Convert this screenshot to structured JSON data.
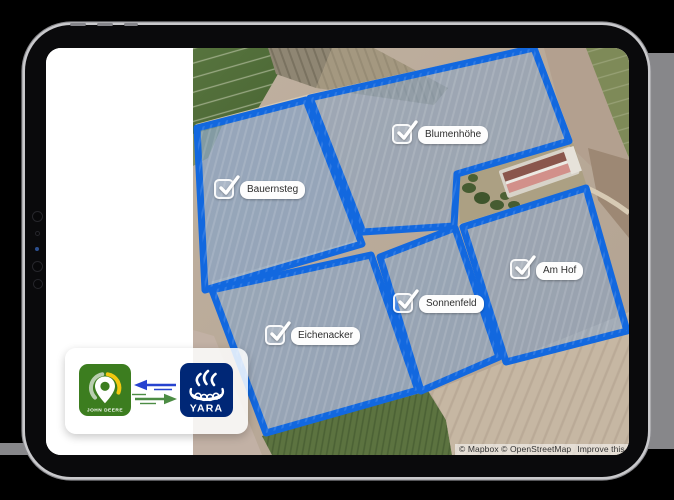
{
  "colors": {
    "page_background": "#000000",
    "backdrop_gray": "#87878A",
    "field_border": "#1268DF",
    "field_fill": "#7FA2CC",
    "jd_green": "#3C7D1F",
    "jd_yellow": "#F3C80F",
    "yara_navy": "#002776",
    "sync_blue": "#2743CF",
    "sync_green": "#4C8C44"
  },
  "device": {
    "type": "tablet",
    "orientation": "landscape"
  },
  "screen": {
    "left_panel": {
      "content": ""
    },
    "map": {
      "attribution": {
        "copyright": "© Mapbox © OpenStreetMap",
        "improve_link": "Improve this map"
      },
      "fields": [
        {
          "id": "bauernsteg",
          "name": "Bauernsteg",
          "checked": true,
          "polygon": "197,128 306,100 362,244 205,290",
          "fill_opacity": 0.62,
          "checkbox_pos": [
            214,
            179
          ],
          "label_pos": [
            240,
            180
          ]
        },
        {
          "id": "blumenhoehe",
          "name": "Blumenhöhe",
          "checked": true,
          "polygon": "310,98 534,48 569,141 457,174 454,226 363,232",
          "fill_opacity": 0.5,
          "checkbox_pos": [
            392,
            124
          ],
          "label_pos": [
            418,
            125
          ]
        },
        {
          "id": "eichenacker",
          "name": "Eichenacker",
          "checked": true,
          "polygon": "212,290 371,255 418,390 266,433",
          "fill_opacity": 0.58,
          "checkbox_pos": [
            265,
            325
          ],
          "label_pos": [
            291,
            326
          ]
        },
        {
          "id": "sonnenfeld",
          "name": "Sonnenfeld",
          "checked": true,
          "polygon": "380,257 455,228 499,357 421,391",
          "fill_opacity": 0.55,
          "checkbox_pos": [
            393,
            293
          ],
          "label_pos": [
            419,
            294
          ]
        },
        {
          "id": "amhof",
          "name": "Am Hof",
          "checked": true,
          "polygon": "463,227 586,188 627,331 506,362",
          "fill_opacity": 0.5,
          "checkbox_pos": [
            510,
            259
          ],
          "label_pos": [
            536,
            261
          ]
        }
      ]
    },
    "sync_overlay": {
      "john_deere_label": "JOHN DEERE",
      "yara_label": "YARA",
      "sync_direction": "bidirectional"
    }
  }
}
